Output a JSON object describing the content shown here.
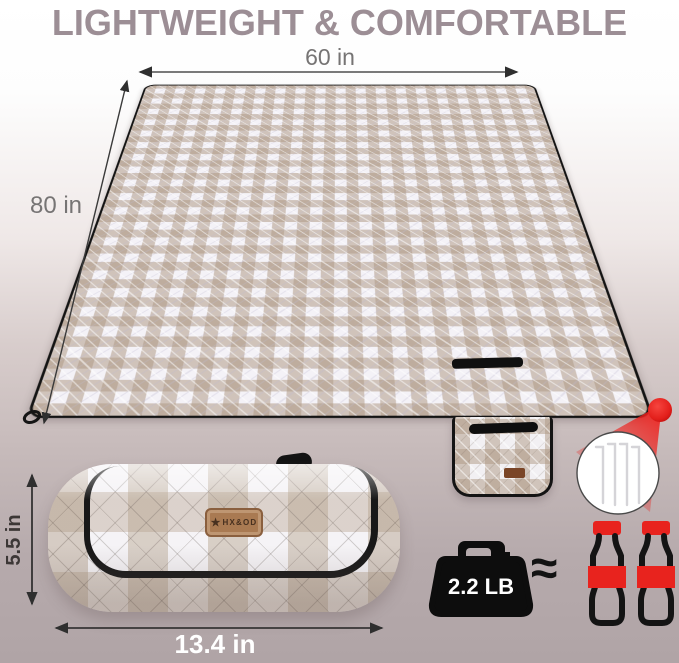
{
  "title": {
    "text": "LIGHTWEIGHT & COMFORTABLE"
  },
  "blanket": {
    "top_width_label": "60 in",
    "side_length_label": "80 in"
  },
  "roll": {
    "height_label": "5.5 in",
    "width_label": "13.4 in",
    "brand_star": "★",
    "brand": "HX&OD"
  },
  "weight": {
    "label": "2.2 LB",
    "approx_symbol": "≈"
  },
  "colors": {
    "accent_red": "#e8231e",
    "title_gray": "#9c8e95",
    "blanket_tan": "#ae9883",
    "label_brown": "#a97a52",
    "background_mauve": "#b0a4a6",
    "trim_black": "#141414"
  }
}
